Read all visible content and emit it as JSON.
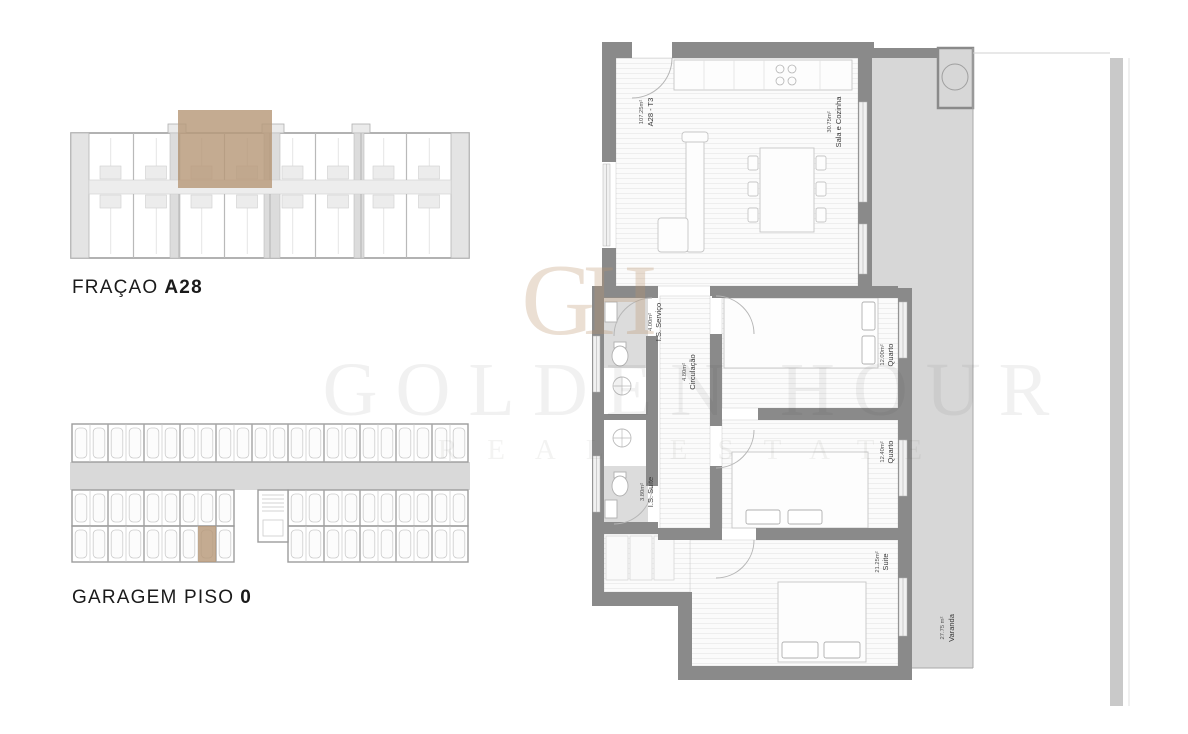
{
  "page": {
    "background": "#ffffff"
  },
  "labels": {
    "fracao": {
      "prefix": "FRAÇAO",
      "value": "A28"
    },
    "garagem": {
      "prefix": "GARAGEM PISO",
      "value": "0"
    }
  },
  "watermark": {
    "monogram": "GH",
    "title": "GOLDEN HOUR",
    "subtitle": "REAL ESTATE"
  },
  "apartment": {
    "unit": {
      "name": "A28 - T3",
      "area": "107.25m²"
    },
    "rooms": {
      "sala": {
        "name": "Sala e Cozinha",
        "area": "30.75m²"
      },
      "is_servico": {
        "name": "I.S. Serviço",
        "area": "4.00m²"
      },
      "circulacao": {
        "name": "Circulação",
        "area": "4.80m²"
      },
      "quarto1": {
        "name": "Quarto",
        "area": "12.00m²"
      },
      "quarto2": {
        "name": "Quarto",
        "area": "12.40m²"
      },
      "is_suite": {
        "name": "I.S. Suite",
        "area": "3.80m²"
      },
      "suite": {
        "name": "Suite",
        "area": "21.25m²"
      },
      "varanda": {
        "name": "Varanda",
        "area": "27.75 m²"
      }
    }
  },
  "building": {
    "units_per_row": 8,
    "highlighted_unit": "A28"
  },
  "garage": {
    "top_row_stalls": 22,
    "mid_left_stalls": 9,
    "mid_right_stalls": 10,
    "bottom_left_stalls": 9,
    "bottom_right_stalls": 10,
    "highlight": {
      "row": "bottom-left",
      "stall_index": 7
    }
  },
  "colors": {
    "wall": "#8a8a8a",
    "bath_floor": "#dcdcdc",
    "balcony": "#d7d7d7",
    "highlight": "#b79879",
    "boundary_bar": "#c9c9c9",
    "heading_text": "#1a1a1a"
  }
}
